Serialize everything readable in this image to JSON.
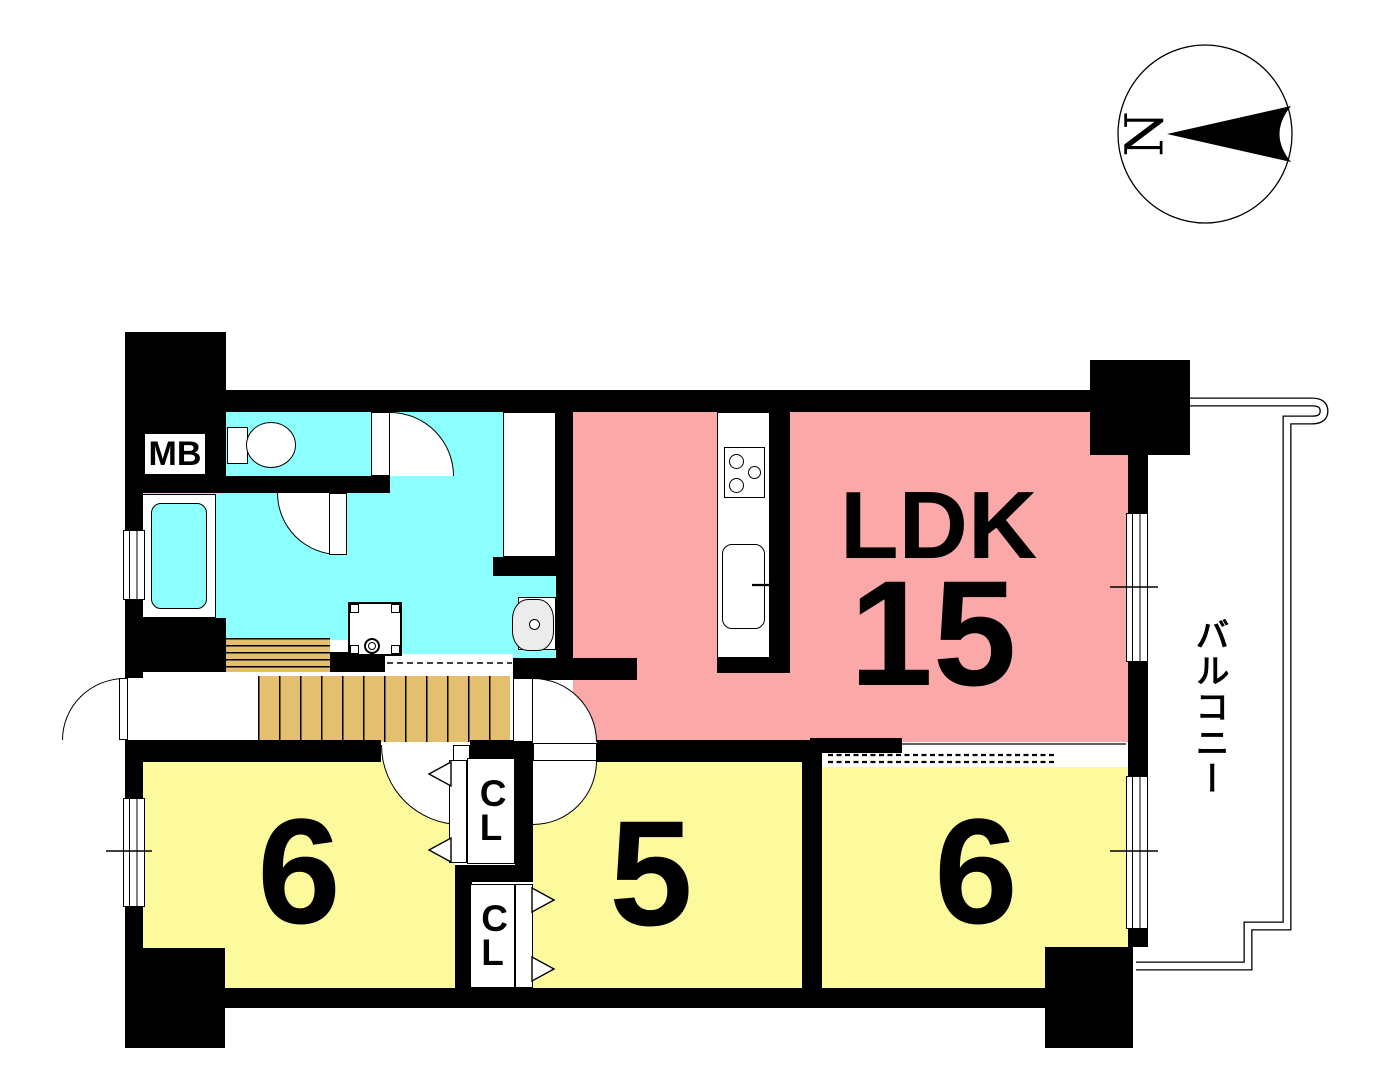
{
  "type": "apartment-floor-plan",
  "compass": {
    "north_label": "N",
    "orientation": "north-left"
  },
  "rooms": {
    "ldk": {
      "label": "LDK",
      "size_tatami": "15",
      "color": "#fba8a8"
    },
    "bedroom_left": {
      "size_tatami": "6",
      "color": "#fdfa9e"
    },
    "bedroom_middle": {
      "size_tatami": "5",
      "color": "#fdfa9e"
    },
    "bedroom_right": {
      "size_tatami": "6",
      "color": "#fdfa9e"
    },
    "balcony": {
      "label": "バルコニー"
    },
    "meter_box": {
      "label": "MB"
    },
    "closet_upper": {
      "label": "CL"
    },
    "closet_lower": {
      "label": "CL"
    }
  },
  "colors": {
    "walls": "#000000",
    "ldk_fill": "#fba8a8",
    "bedroom_fill": "#fdfa9e",
    "wet_area_fill": "#8cffff",
    "stairs_fill": "#e4bf70",
    "fixture_fill": "#ffffff",
    "sink_bowl_fill": "#ececec"
  },
  "icons": [
    "compass-icon",
    "toilet-icon",
    "bathtub-icon",
    "vanity-sink-icon",
    "washer-pan-icon",
    "stove-icon",
    "kitchen-sink-icon",
    "stairs-icon",
    "door-swing-icon",
    "folding-door-icon",
    "sliding-partition-icon",
    "window-icon"
  ]
}
